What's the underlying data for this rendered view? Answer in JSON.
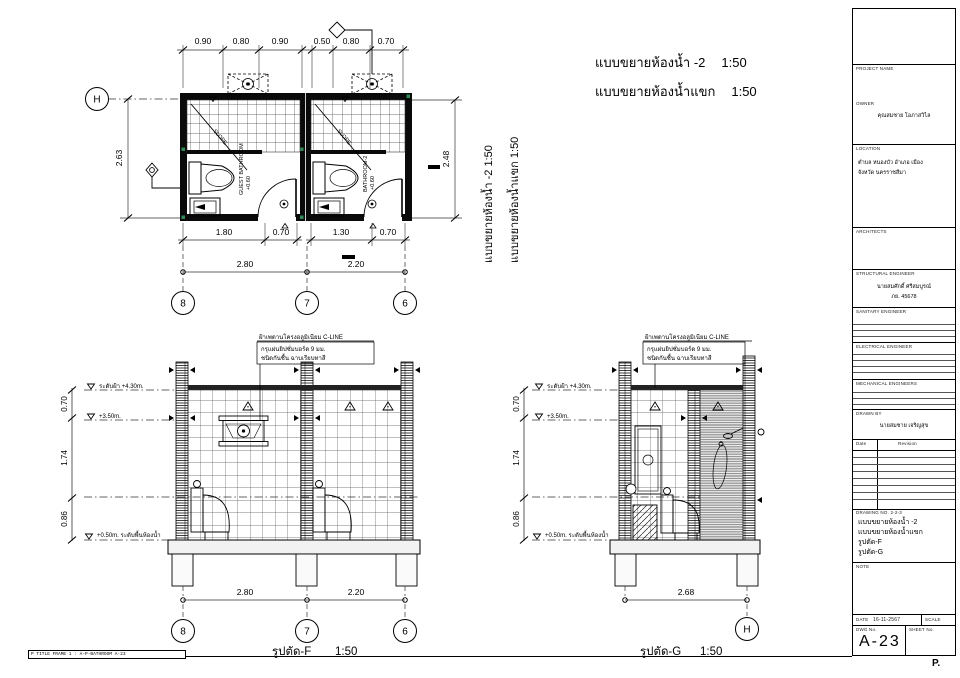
{
  "page": {
    "corner_mark": "P.",
    "stamp_text": "P TITLE FRAME 1 : A-P-BATHROOM  A-23"
  },
  "titles": {
    "t1": "แบบขยายห้องน้ำ -2",
    "t1_scale": "1:50",
    "t2": "แบบขยายห้องน้ำแขก",
    "t2_scale": "1:50",
    "v1": "แบบขยายห้องน้ำ -2  1:50",
    "v2": "แบบขยายห้องน้ำแขก  1:50",
    "sf": "รูปตัด-F",
    "sf_scale": "1:50",
    "sg": "รูปตัด-G",
    "sg_scale": "1:50"
  },
  "plan": {
    "top_dims": [
      "0.90",
      "0.80",
      "0.90",
      "0.50",
      "0.80",
      "0.70"
    ],
    "left_dim": "2.63",
    "right_dim": "2.48",
    "inner_dims": [
      "1.80",
      "0.70",
      "1.30",
      "0.70"
    ],
    "total_dims": [
      "2.80",
      "2.20"
    ],
    "bubbles": [
      "8",
      "7",
      "6"
    ],
    "row_bubble": "H",
    "room1": "GUEST BATHROOM",
    "room1_level": "+0.60",
    "room2": "BATHROOM-2",
    "room2_level": "+0.60",
    "slope": "SLOPE"
  },
  "sections": {
    "note1": "ฝ้าเพดานโครงอลูมิเนียม C-LINE",
    "note2": "กรุแผ่นยิปซั่มบอร์ด 9 มม.",
    "note3": "ชนิดกันชื้น ฉาบเรียบทาสี",
    "level_ceiling": "ระดับฝ้า +4.30m.",
    "level_mid": "+3.50m.",
    "level_floor": "+0.50m. ระดับพื้นห้องน้ำ",
    "v_dims": [
      "0.70",
      "1.74",
      "0.86"
    ],
    "f_bottom_dims": [
      "2.80",
      "2.20"
    ],
    "f_bubbles": [
      "8",
      "7",
      "6"
    ],
    "g_bottom_dim": "2.68",
    "g_bubble": "H"
  },
  "titleblock": {
    "project_label": "PROJECT NAME",
    "owner_label": "OWNER",
    "owner_name": "คุณสมชาย โอภาสวิไล",
    "location_label": "LOCATION",
    "location_line1": "ตำบล หนองบัว อำเภอ เมือง",
    "location_line2": "จังหวัด นครราชสีมา",
    "architect_label": "ARCHITECTS",
    "structural_label": "STRUCTURAL ENGINEER",
    "structural_name": "นายสมศักดิ์ ศรีสมบูรณ์",
    "structural_license": "ภย. 45678",
    "sanitary_label": "SANITARY ENGINEER",
    "electrical_label": "ELECTRICAL ENGINEER",
    "mechanical_label": "MECHANICAL ENGINEERS",
    "drawn_label": "DRAWN BY",
    "drawn_name": "นายสมชาย เจริญสุข",
    "rev_col1": "Date",
    "rev_col2": "Revision",
    "dwg_list_label": "DRAWING NO. 2-2-3",
    "list1": "แบบขยายห้องน้ำ -2",
    "list2": "แบบขยายห้องน้ำแขก",
    "list3": "รูปตัด-F",
    "list4": "รูปตัด-G",
    "note_label": "NOTE",
    "date_label": "DATE",
    "date_value": "16-11-2567",
    "scale_label": "SCALE",
    "dwg_no_label": "DWG No.",
    "sheet_no_label": "SHEET No.",
    "sheet_no": "A-23"
  }
}
